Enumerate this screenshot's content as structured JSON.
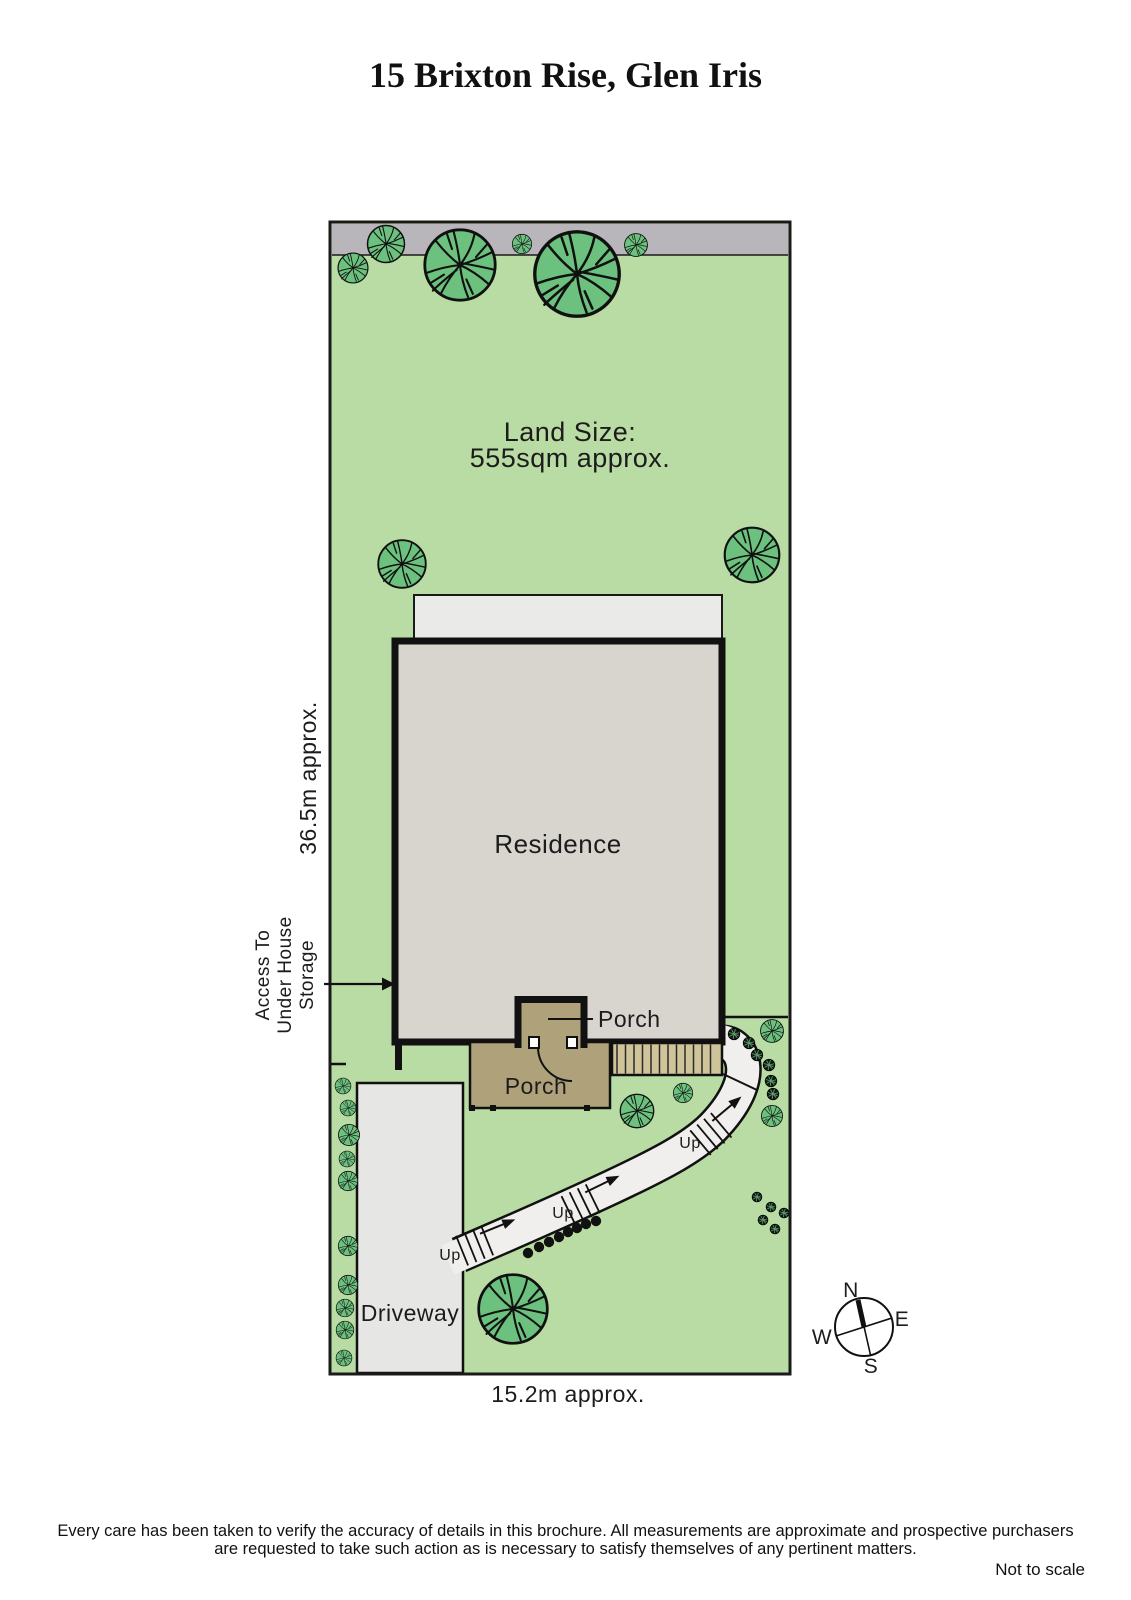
{
  "page": {
    "title": "15 Brixton Rise, Glen Iris"
  },
  "plan": {
    "land_size": {
      "line1": "Land Size:",
      "line2": "555sqm approx."
    },
    "labels": {
      "residence": "Residence",
      "porch_inner": "Porch",
      "porch_lower": "Porch",
      "driveway": "Driveway",
      "depth": "36.5m approx.",
      "width": "15.2m approx.",
      "access": [
        "Access To",
        "Under House",
        "Storage"
      ],
      "up": "Up"
    },
    "compass": {
      "n": "N",
      "e": "E",
      "s": "S",
      "w": "W"
    },
    "colors": {
      "grass": "#b9dca4",
      "nature_strip": "#b9b6bb",
      "residence": "#d8d4ce",
      "eave": "#eaeae8",
      "porch": "#afa27b",
      "steps": "#cfc39a",
      "path": "#f0efed",
      "driveway": "#e6e6e4",
      "tree": "#6cc17e",
      "shrub": "#161616",
      "outline": "#1a1a1a"
    },
    "trees": [
      [
        353,
        268,
        17
      ],
      [
        386,
        244,
        21
      ],
      [
        460,
        265,
        40
      ],
      [
        522,
        244,
        11
      ],
      [
        577,
        274,
        48
      ],
      [
        636,
        245,
        13
      ],
      [
        402,
        564,
        27
      ],
      [
        752,
        555,
        31
      ],
      [
        637,
        1111,
        19
      ],
      [
        683,
        1093,
        11
      ],
      [
        772,
        1031,
        13
      ],
      [
        772,
        1116,
        12
      ],
      [
        513,
        1309,
        39
      ],
      [
        343,
        1086,
        9
      ],
      [
        348,
        1108,
        9
      ],
      [
        349,
        1135,
        12
      ],
      [
        347,
        1159,
        9
      ],
      [
        348,
        1181,
        11
      ],
      [
        348,
        1246,
        11
      ],
      [
        348,
        1285,
        11
      ],
      [
        345,
        1308,
        10
      ],
      [
        345,
        1330,
        10
      ],
      [
        344,
        1358,
        9
      ]
    ],
    "shrubs": [
      [
        734,
        1034,
        7
      ],
      [
        749,
        1043,
        7
      ],
      [
        757,
        1055,
        7
      ],
      [
        769,
        1065,
        7
      ],
      [
        771,
        1081,
        7
      ],
      [
        773,
        1094,
        7
      ],
      [
        757,
        1197,
        6
      ],
      [
        771,
        1207,
        6
      ],
      [
        784,
        1213,
        6
      ],
      [
        763,
        1220,
        6
      ],
      [
        775,
        1229,
        6
      ]
    ],
    "path_dots": [
      [
        528,
        1253
      ],
      [
        539,
        1247
      ],
      [
        549,
        1242
      ],
      [
        559,
        1237
      ],
      [
        568,
        1232
      ],
      [
        577,
        1228
      ],
      [
        586,
        1224
      ],
      [
        596,
        1221
      ]
    ],
    "porch_posts": [
      [
        472,
        1108
      ],
      [
        493,
        1108
      ],
      [
        587,
        1108
      ]
    ],
    "stair_crossings": [
      {
        "x": 712,
        "y": 1133,
        "angle": -40,
        "label_x": 690,
        "label_y": 1148
      },
      {
        "x": 582,
        "y": 1204,
        "angle": -26,
        "label_x": 563,
        "label_y": 1218
      },
      {
        "x": 476,
        "y": 1245,
        "angle": -22,
        "label_x": 450,
        "label_y": 1260
      }
    ]
  },
  "footer": {
    "line1": "Every care has been taken to verify the accuracy of details in this brochure.  All measurements are approximate and prospective purchasers",
    "line2": "are requested to take such action as is necessary to satisfy themselves of any pertinent matters.",
    "scale_note": "Not to scale"
  }
}
